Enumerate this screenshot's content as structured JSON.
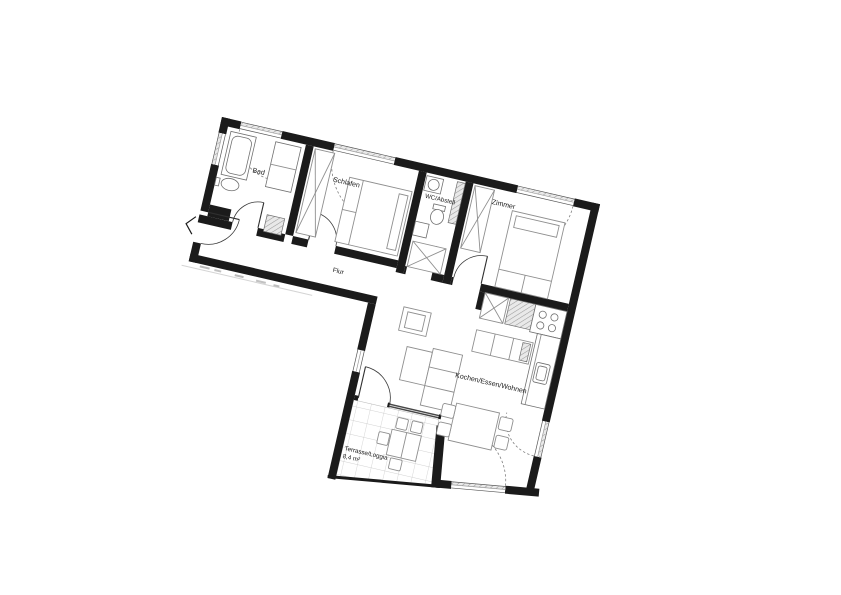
{
  "plan": {
    "rotation_deg": 13,
    "colors": {
      "wall": "#1b1b1b",
      "furniture_line": "#8f8f8f",
      "hatch_line": "#9a9a9a",
      "tile_line": "#c4c4c4",
      "background": "#ffffff"
    },
    "rooms": {
      "bad": {
        "label": "Bad"
      },
      "schlafen": {
        "label": "Schlafen"
      },
      "wc_abstell": {
        "label": "WC/Abstell"
      },
      "zimmer": {
        "label": "Zimmer"
      },
      "flur": {
        "label": "Flur"
      },
      "kochen_essen_wohnen": {
        "label": "Kochen/Essen/Wohnen"
      },
      "terrasse": {
        "label": "Terrasse/Loggia",
        "area": "8,4 m²"
      }
    }
  }
}
